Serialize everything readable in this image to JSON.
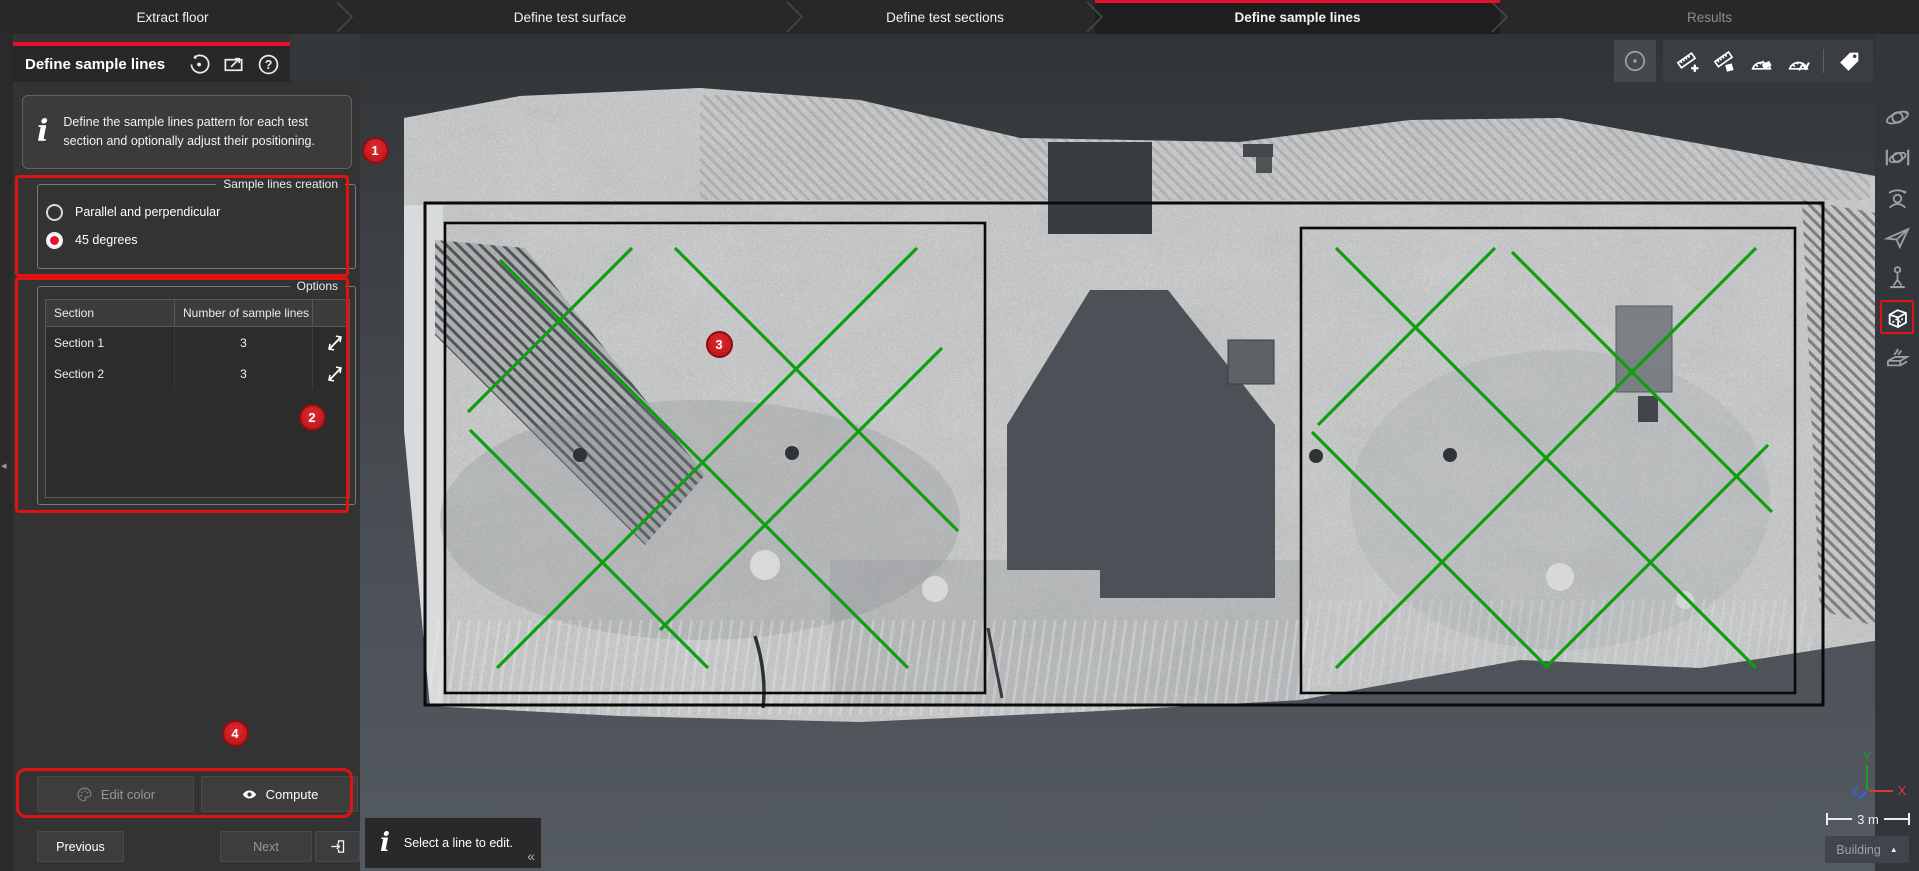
{
  "colors": {
    "accent_red": "#e8112a",
    "annotation_red": "#e01313",
    "sample_line_green": "#0f9e12",
    "section_outline_black": "#0a0a0a",
    "radio_selected_red": "#e8112d"
  },
  "workflow": {
    "tabs": [
      {
        "label": "Extract floor",
        "state": "normal"
      },
      {
        "label": "Define test surface",
        "state": "normal"
      },
      {
        "label": "Define test sections",
        "state": "normal"
      },
      {
        "label": "Define sample lines",
        "state": "active"
      },
      {
        "label": "Results",
        "state": "disabled"
      }
    ]
  },
  "panel": {
    "title": "Define sample lines",
    "header_icons": [
      {
        "name": "history-reset-icon"
      },
      {
        "name": "popout-panel-icon"
      },
      {
        "name": "help-icon"
      }
    ],
    "info_text": "Define the sample lines pattern for each test section and optionally adjust their positioning.",
    "creation_group": {
      "legend": "Sample lines creation",
      "options": [
        {
          "label": "Parallel and perpendicular",
          "selected": false
        },
        {
          "label": "45 degrees",
          "selected": true
        }
      ]
    },
    "options_group": {
      "legend": "Options",
      "table": {
        "columns": [
          "Section",
          "Number of sample lines",
          ""
        ],
        "rows": [
          {
            "section": "Section 1",
            "count": "3",
            "icon": "reverse-line-direction-icon"
          },
          {
            "section": "Section 2",
            "count": "3",
            "icon": "reverse-line-direction-icon"
          }
        ]
      }
    },
    "buttons": {
      "edit_color": {
        "label": "Edit color",
        "enabled": false,
        "icon": "palette-icon"
      },
      "compute": {
        "label": "Compute",
        "enabled": true,
        "icon": "eye-icon"
      },
      "previous": {
        "label": "Previous",
        "enabled": true
      },
      "next": {
        "label": "Next",
        "enabled": false
      },
      "exit": {
        "icon": "exit-workflow-icon"
      }
    }
  },
  "annotations": {
    "badges": [
      {
        "n": "1",
        "x": 375,
        "y": 150
      },
      {
        "n": "2",
        "x": 312,
        "y": 417
      },
      {
        "n": "3",
        "x": 719,
        "y": 344
      },
      {
        "n": "4",
        "x": 235,
        "y": 733
      }
    ],
    "boxes": [
      {
        "x": 15,
        "y": 175,
        "w": 334,
        "h": 102,
        "r": 4
      },
      {
        "x": 15,
        "y": 277,
        "w": 334,
        "h": 236,
        "r": 4
      },
      {
        "x": 16,
        "y": 768,
        "w": 337,
        "h": 50,
        "r": 10
      }
    ]
  },
  "viewport": {
    "hint": "Select a line to edit.",
    "collapse_glyph": "«",
    "edge_collapse_glyph": "◂",
    "scale_label": "3 m",
    "building_label": "Building",
    "building_caret": "▲",
    "axis": {
      "x": "X",
      "y": "Y",
      "z": "Z",
      "x_color": "#e03636",
      "y_color": "#1f9e1f",
      "z_color": "#3a62ff"
    },
    "top_toolbar": [
      {
        "name": "point-reference-icon",
        "grouped": false
      },
      {
        "name": "add-measurement-icon",
        "grouped": true
      },
      {
        "name": "measure-patch-icon",
        "grouped": true
      },
      {
        "name": "angle-eraser-icon",
        "grouped": true
      },
      {
        "name": "angle-polyline-icon",
        "grouped": true
      },
      {
        "name": "tag-icon",
        "grouped": true
      }
    ],
    "right_toolbar": [
      {
        "name": "orbit-icon",
        "active": false
      },
      {
        "name": "constrained-orbit-icon",
        "active": false
      },
      {
        "name": "look-around-icon",
        "active": false
      },
      {
        "name": "fly-icon",
        "active": false
      },
      {
        "name": "walk-icon",
        "active": false
      },
      {
        "name": "view-cube-icon",
        "active": true
      },
      {
        "name": "clipping-box-icon",
        "active": false
      }
    ]
  },
  "scene": {
    "surface_rect": [
      425,
      203,
      1823,
      705
    ],
    "sections": [
      {
        "name": "Section 1",
        "rect": [
          445,
          223,
          985,
          693
        ],
        "lines": [
          [
            468,
            412,
            632,
            248
          ],
          [
            497,
            668,
            917,
            248
          ],
          [
            660,
            630,
            942,
            348
          ],
          [
            500,
            260,
            908,
            668
          ],
          [
            675,
            248,
            958,
            531
          ],
          [
            470,
            430,
            708,
            668
          ]
        ]
      },
      {
        "name": "Section 2",
        "rect": [
          1301,
          228,
          1795,
          693
        ],
        "lines": [
          [
            1318,
            425,
            1495,
            248
          ],
          [
            1336,
            668,
            1756,
            248
          ],
          [
            1545,
            668,
            1768,
            445
          ],
          [
            1336,
            248,
            1756,
            668
          ],
          [
            1512,
            252,
            1772,
            512
          ],
          [
            1312,
            432,
            1548,
            668
          ]
        ]
      }
    ]
  }
}
